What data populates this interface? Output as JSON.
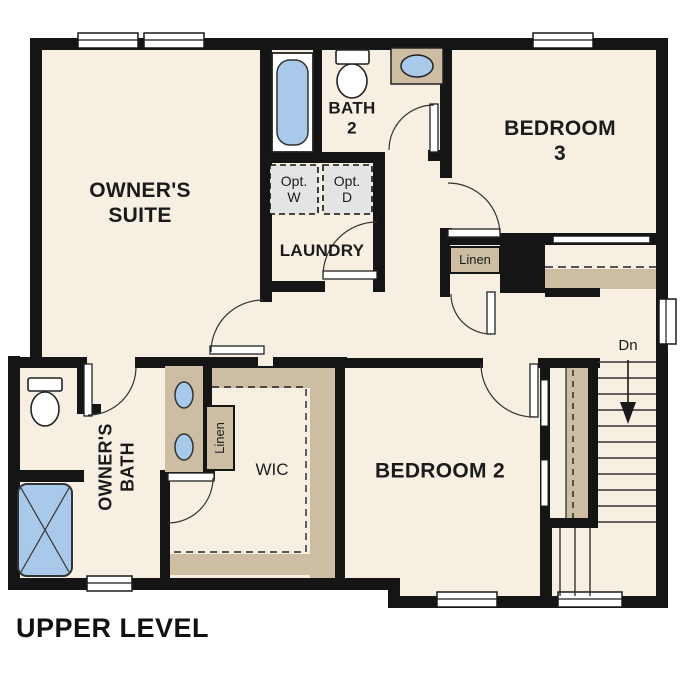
{
  "plan_title": "UPPER LEVEL",
  "colors": {
    "floor": "#f7efe2",
    "wall": "#151515",
    "cabinet_tan": "#ccbda3",
    "water_blue": "#a9c9ea",
    "appliance_gray": "#e4e4e4"
  },
  "rooms": {
    "owners_suite": {
      "label": "OWNER'S\nSUITE"
    },
    "bath2": {
      "label": "BATH\n2"
    },
    "bedroom3": {
      "label": "BEDROOM 3"
    },
    "laundry": {
      "label": "LAUNDRY"
    },
    "owners_bath": {
      "label": "OWNER'S\nBATH"
    },
    "wic": {
      "label": "WIC"
    },
    "bedroom2": {
      "label": "BEDROOM 2"
    }
  },
  "closets": {
    "hall_linen": {
      "label": "Linen"
    },
    "bath_linen": {
      "label": "Linen"
    }
  },
  "appliances": {
    "washer": {
      "label": "Opt.\nW"
    },
    "dryer": {
      "label": "Opt.\nD"
    }
  },
  "stairs": {
    "down_label": "Dn"
  }
}
